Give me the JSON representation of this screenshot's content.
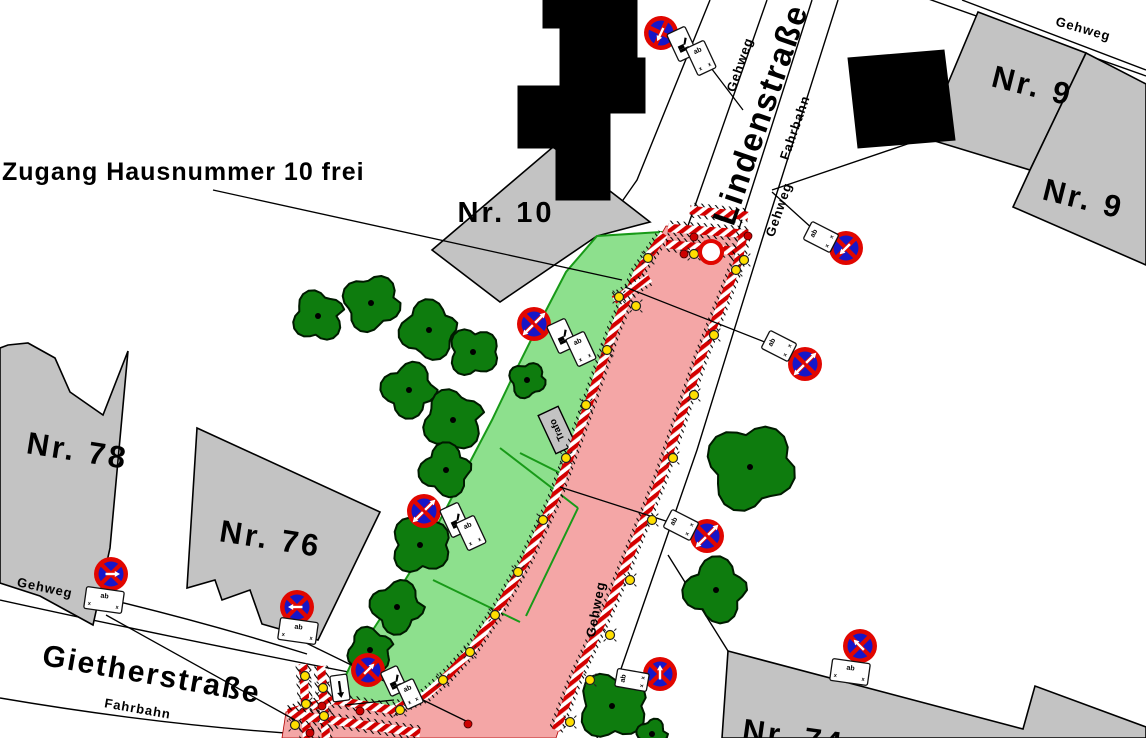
{
  "annotation": {
    "text": "Zugang Hausnummer 10 frei"
  },
  "street_labels": {
    "lindenstrasse": "Lindenstraße",
    "lindenstrasse_fahrbahn": "Fahrbahn",
    "gietherstrasse": "Gietherstraße",
    "gietherstrasse_fahrbahn": "Fahrbahn",
    "gehweg_west": "Gehweg",
    "gehweg_east": "Gehweg",
    "gehweg_south": "Gehweg",
    "gehweg_top_right": "Gehweg",
    "gehweg_bottom_left": "Gehweg"
  },
  "parcel_labels": {
    "nr10": "Nr. 10",
    "nr9a": "Nr. 9",
    "nr9b": "Nr. 9",
    "nr78": "Nr. 78",
    "nr76": "Nr. 76",
    "nr74": "Nr. 74"
  },
  "trafo": "Trafo",
  "sign_plate_text": {
    "top": "ab",
    "bottom_left": "x",
    "bottom_right": "x"
  },
  "colors": {
    "work_area_green": "#8de08d",
    "closed_area_red": "#f4a6a6",
    "barrier_red": "#d40000",
    "sign_ring_red": "#e10600",
    "sign_blue": "#1616c8",
    "lamp_yellow": "#ffdf00",
    "tree_green": "#0e7c0e",
    "building_gray": "#c3c3c3"
  },
  "geometry": {
    "trees": [
      [
        318,
        316,
        27
      ],
      [
        371,
        303,
        30
      ],
      [
        429,
        330,
        31
      ],
      [
        473,
        352,
        26
      ],
      [
        409,
        390,
        29
      ],
      [
        453,
        420,
        32
      ],
      [
        527,
        380,
        19
      ],
      [
        446,
        470,
        28
      ],
      [
        420,
        545,
        31
      ],
      [
        397,
        607,
        28
      ],
      [
        370,
        650,
        24
      ],
      [
        750,
        467,
        46
      ],
      [
        716,
        590,
        34
      ],
      [
        612,
        706,
        36
      ],
      [
        652,
        734,
        16
      ]
    ],
    "lamps": [
      [
        648,
        258
      ],
      [
        607,
        350
      ],
      [
        586,
        405
      ],
      [
        566,
        458
      ],
      [
        543,
        520
      ],
      [
        518,
        572
      ],
      [
        495,
        615
      ],
      [
        470,
        652
      ],
      [
        443,
        680
      ],
      [
        400,
        710
      ],
      [
        736,
        270
      ],
      [
        714,
        335
      ],
      [
        694,
        395
      ],
      [
        673,
        458
      ],
      [
        652,
        520
      ],
      [
        630,
        580
      ],
      [
        610,
        635
      ],
      [
        590,
        680
      ],
      [
        570,
        722
      ],
      [
        694,
        254
      ],
      [
        744,
        260
      ],
      [
        619,
        297
      ],
      [
        636,
        306
      ],
      [
        305,
        676
      ],
      [
        323,
        688
      ],
      [
        306,
        704
      ],
      [
        324,
        716
      ],
      [
        295,
        725
      ]
    ],
    "red_dots": [
      [
        694,
        237
      ],
      [
        714,
        246
      ],
      [
        748,
        236
      ],
      [
        684,
        254
      ],
      [
        322,
        706
      ],
      [
        310,
        733
      ],
      [
        468,
        724
      ],
      [
        360,
        711
      ]
    ],
    "chains": [
      "M690,210 L748,216",
      "M668,228 L748,234",
      "M666,244 L744,252",
      "M664,234 L638,272 L613,332 L583,420 L554,500 L526,560 L498,610 L473,648 L449,674 L426,695 L392,710 L334,700 L288,713",
      "M744,232 L738,262 L700,360 L660,480 L612,600 L575,680 L556,730",
      "M614,300 L650,278",
      "M303,664 L307,738",
      "M321,666 L326,738",
      "M288,714 L420,733"
    ],
    "green_lines": [
      [
        500,
        448,
        578,
        508
      ],
      [
        578,
        508,
        526,
        616
      ],
      [
        433,
        580,
        520,
        622
      ],
      [
        520,
        453,
        560,
        473
      ]
    ],
    "leaders": [
      [
        705,
        60,
        743,
        110
      ],
      [
        213,
        190,
        622,
        280
      ],
      [
        772,
        192,
        814,
        230
      ],
      [
        790,
        352,
        625,
        287
      ],
      [
        672,
        523,
        560,
        487
      ],
      [
        106,
        615,
        295,
        720
      ],
      [
        300,
        640,
        468,
        722
      ],
      [
        394,
        700,
        345,
        705
      ]
    ],
    "ring_marker": {
      "x": 711,
      "y": 252,
      "r": 11
    },
    "down_arrow_plate": {
      "x": 340,
      "y": 688,
      "w": 17,
      "h": 26,
      "rot": -8
    },
    "signs": [
      {
        "cx": 661,
        "cy": 33,
        "rot": -20,
        "arrows": [
          "dl"
        ],
        "plates": [
          {
            "x": 682,
            "y": 44,
            "rot": -25,
            "w": 20,
            "h": 30,
            "type": "picto"
          },
          {
            "x": 701,
            "y": 58,
            "rot": -25,
            "w": 20,
            "h": 30,
            "type": "dates"
          }
        ]
      },
      {
        "cx": 534,
        "cy": 324,
        "rot": 0,
        "arrows": [
          "dl",
          "ur"
        ],
        "plates": [
          {
            "x": 562,
            "y": 336,
            "rot": -25,
            "w": 20,
            "h": 30,
            "type": "picto"
          },
          {
            "x": 581,
            "y": 349,
            "rot": -25,
            "w": 20,
            "h": 30,
            "type": "dates"
          }
        ]
      },
      {
        "cx": 424,
        "cy": 511,
        "rot": 0,
        "arrows": [
          "dl",
          "ur"
        ],
        "plates": [
          {
            "x": 455,
            "y": 520,
            "rot": -25,
            "w": 20,
            "h": 30,
            "type": "picto"
          },
          {
            "x": 471,
            "y": 533,
            "rot": -25,
            "w": 20,
            "h": 30,
            "type": "dates"
          }
        ]
      },
      {
        "cx": 846,
        "cy": 248,
        "rot": 0,
        "arrows": [
          "dl"
        ],
        "plates": [
          {
            "x": 821,
            "y": 237,
            "rot": -63,
            "w": 20,
            "h": 30,
            "type": "dates"
          }
        ]
      },
      {
        "cx": 805,
        "cy": 364,
        "rot": 0,
        "arrows": [
          "dl",
          "ur"
        ],
        "plates": [
          {
            "x": 779,
            "y": 346,
            "rot": -63,
            "w": 20,
            "h": 30,
            "type": "dates"
          }
        ]
      },
      {
        "cx": 707,
        "cy": 536,
        "rot": 0,
        "arrows": [
          "dl",
          "ur"
        ],
        "plates": [
          {
            "x": 681,
            "y": 525,
            "rot": -63,
            "w": 20,
            "h": 30,
            "type": "dates"
          }
        ]
      },
      {
        "cx": 111,
        "cy": 574,
        "rot": 0,
        "arrows": [
          "r"
        ],
        "plates": [
          {
            "x": 104,
            "y": 600,
            "rot": 8,
            "w": 38,
            "h": 22,
            "type": "dates"
          }
        ]
      },
      {
        "cx": 297,
        "cy": 607,
        "rot": 0,
        "arrows": [
          "l"
        ],
        "plates": [
          {
            "x": 298,
            "y": 631,
            "rot": 8,
            "w": 38,
            "h": 22,
            "type": "dates"
          }
        ]
      },
      {
        "cx": 368,
        "cy": 670,
        "rot": 0,
        "arrows": [
          "ur"
        ],
        "plates": [
          {
            "x": 394,
            "y": 681,
            "rot": -25,
            "w": 18,
            "h": 26,
            "type": "picto"
          },
          {
            "x": 410,
            "y": 694,
            "rot": -25,
            "w": 18,
            "h": 26,
            "type": "dates"
          }
        ]
      },
      {
        "cx": 660,
        "cy": 674,
        "rot": 0,
        "arrows": [
          "u"
        ],
        "plates": [
          {
            "x": 632,
            "y": 680,
            "rot": -80,
            "w": 18,
            "h": 32,
            "type": "dates"
          }
        ]
      },
      {
        "cx": 860,
        "cy": 646,
        "rot": 0,
        "arrows": [
          "ul"
        ],
        "plates": [
          {
            "x": 850,
            "y": 672,
            "rot": 8,
            "w": 38,
            "h": 22,
            "type": "dates"
          }
        ]
      }
    ]
  }
}
